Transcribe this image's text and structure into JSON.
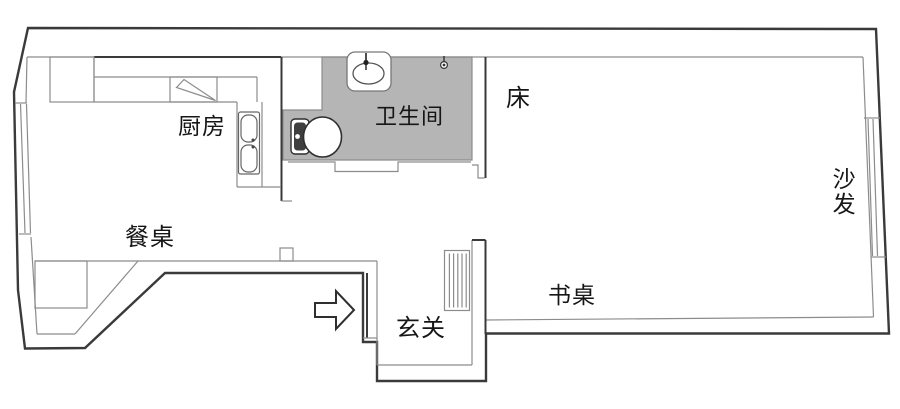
{
  "floorplan": {
    "labels": {
      "kitchen": "厨房",
      "bathroom": "卫生间",
      "bed": "床",
      "sofa": "沙发",
      "dining_table": "餐桌",
      "desk": "书桌",
      "entry": "玄关"
    },
    "colors": {
      "wall_outline": "#3a3a3a",
      "inner_line": "#8c8c8c",
      "bathroom_floor": "#b5b5b5",
      "background": "#ffffff",
      "text": "#161616"
    },
    "icons": {
      "entrance_arrow": "right-arrow",
      "fixtures": [
        "toilet",
        "washbasin",
        "shower",
        "kitchen-sink",
        "cooktop",
        "radiator",
        "wardrobe"
      ]
    }
  }
}
